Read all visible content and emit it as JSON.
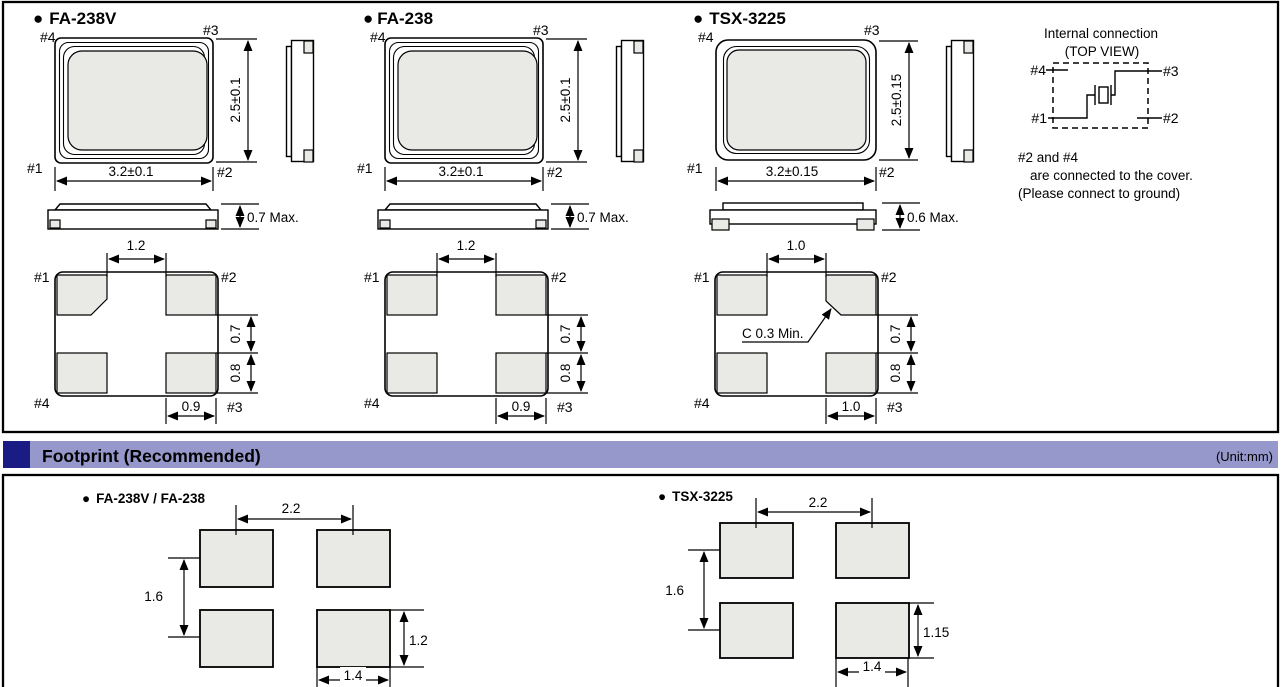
{
  "bullet": "●",
  "colors": {
    "band": "#9698cb",
    "navy": "#1b1b84",
    "pad": "#e9e9e6",
    "line": "#000000"
  },
  "pins": {
    "p1": "#1",
    "p2": "#2",
    "p3": "#3",
    "p4": "#4"
  },
  "packages": [
    {
      "name": "FA-238V",
      "width_dim": "3.2±0.1",
      "height_dim": "2.5±0.1",
      "profile_dim": "0.7 Max.",
      "pad_top_dim": "1.2",
      "pad_gap_dim": "0.7",
      "pad_height_dim": "0.8",
      "pad_width_dim": "0.9"
    },
    {
      "name": "FA-238",
      "width_dim": "3.2±0.1",
      "height_dim": "2.5±0.1",
      "profile_dim": "0.7 Max.",
      "pad_top_dim": "1.2",
      "pad_gap_dim": "0.7",
      "pad_height_dim": "0.8",
      "pad_width_dim": "0.9"
    },
    {
      "name": "TSX-3225",
      "width_dim": "3.2±0.15",
      "height_dim": "2.5±0.15",
      "profile_dim": "0.6 Max.",
      "pad_top_dim": "1.0",
      "pad_gap_dim": "0.7",
      "pad_height_dim": "0.8",
      "pad_width_dim": "1.0",
      "chamfer_note": "C 0.3 Min."
    }
  ],
  "internal_connection": {
    "title_line1": "Internal connection",
    "title_line2": "(TOP VIEW)",
    "note_line1": "#2 and #4",
    "note_line2": "are connected to the cover.",
    "note_line3": "(Please connect to ground)"
  },
  "footprint_section": {
    "title": "Footprint (Recommended)",
    "unit": "(Unit:mm)"
  },
  "footprints": [
    {
      "name": "FA-238V / FA-238",
      "pitch_x": "2.2",
      "pitch_y": "1.6",
      "pad_height": "1.2",
      "pad_width": "1.4"
    },
    {
      "name": "TSX-3225",
      "pitch_x": "2.2",
      "pitch_y": "1.6",
      "pad_height": "1.15",
      "pad_width": "1.4"
    }
  ]
}
